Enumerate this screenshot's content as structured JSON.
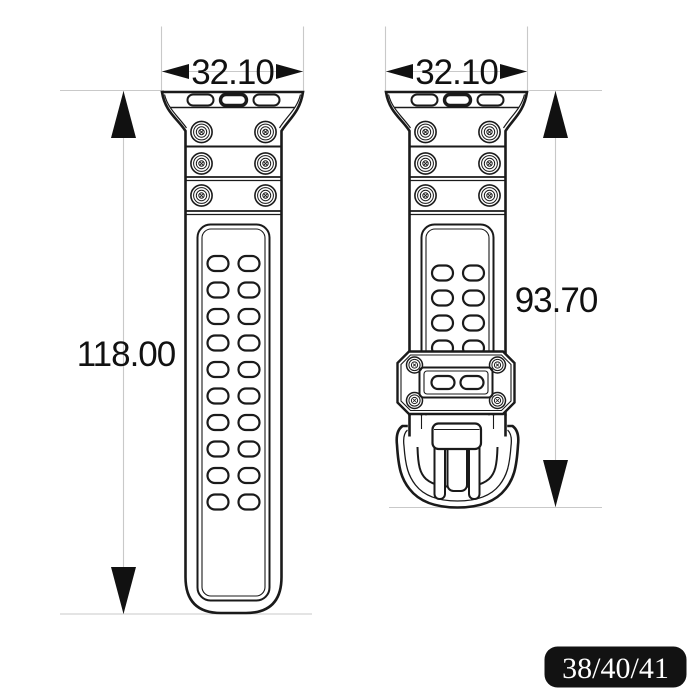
{
  "views": {
    "front": {
      "width_label": "32.10",
      "length_label": "118.00"
    },
    "back": {
      "width_label": "32.10",
      "length_label": "93.70"
    }
  },
  "badge": {
    "label": "38/40/41"
  },
  "colors": {
    "line": "#1a1a1a",
    "construction_line": "#c9c9c9",
    "badge_background": "#121212",
    "badge_text": "#ffffff",
    "background": "#ffffff"
  }
}
